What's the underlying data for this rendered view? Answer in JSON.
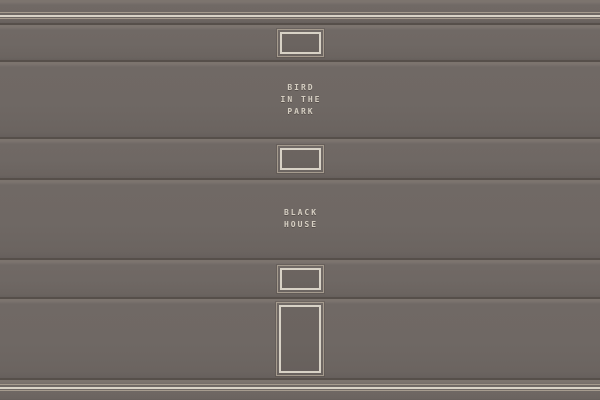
{
  "shelf": {
    "description_visible_text_only": "",
    "books": [
      {
        "name": "spine-top-lines",
        "decoration": "triple-line-ornament"
      },
      {
        "name": "spine-label-frame-1",
        "decoration": "label-frame"
      },
      {
        "name": "spine-bird-in-the-park",
        "title": "BIRD IN THE PARK",
        "title_lines": [
          "BIRD",
          "IN THE",
          "PARK"
        ]
      },
      {
        "name": "spine-label-frame-2",
        "decoration": "label-frame"
      },
      {
        "name": "spine-black-house",
        "title": "BLACK HOUSE",
        "title_lines": [
          "BLACK",
          "HOUSE"
        ]
      },
      {
        "name": "spine-label-frame-3",
        "decoration": "label-frame"
      },
      {
        "name": "spine-tall-frame",
        "decoration": "tall-label-frame"
      },
      {
        "name": "spine-bottom-lines",
        "decoration": "triple-line-ornament"
      }
    ]
  },
  "colors": {
    "spine_body": "#6f6864",
    "spine_highlight": "#7c746e",
    "spine_shadow": "#665f5c",
    "gap_line": "#564f4a",
    "ornament_cream": "#d8d2c6",
    "ornament_beige": "#a59b8e",
    "title_text": "#d5cec2"
  }
}
